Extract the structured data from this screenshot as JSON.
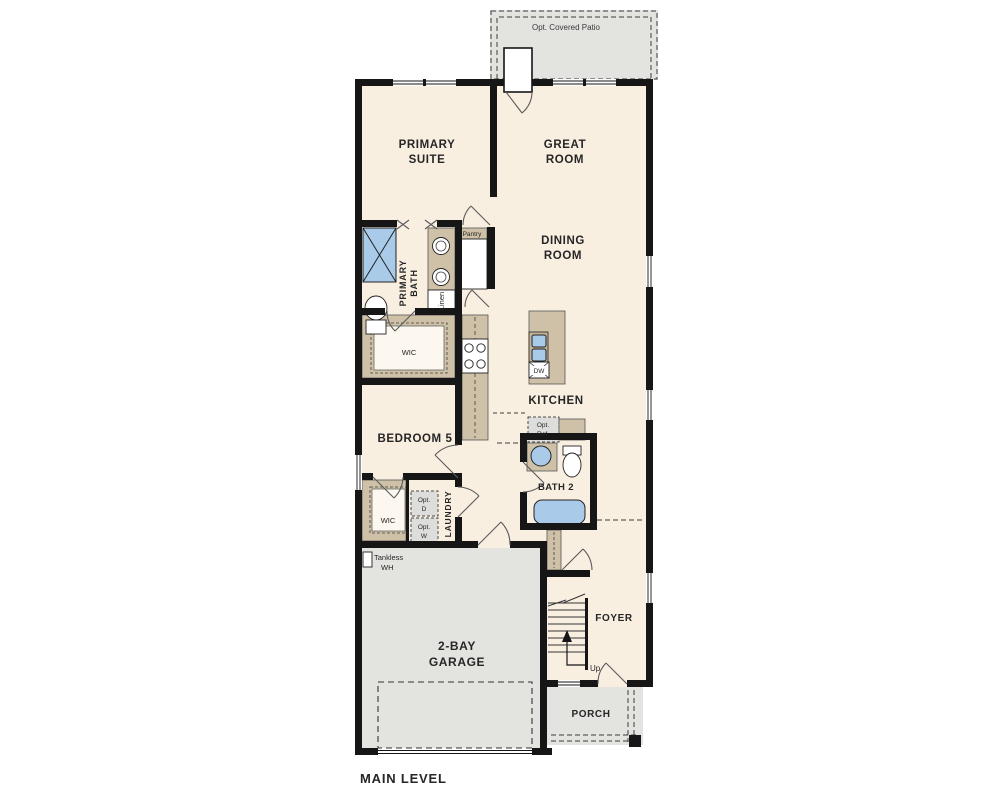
{
  "palette": {
    "floor": "#f8efe1",
    "outdoor": "#e3e3e0",
    "wall": "#161616",
    "cabinet_tan": "#cfc1a7",
    "fixture_blue": "#a9cbe9",
    "optional_gray": "#dddddb",
    "label_text": "#262626"
  },
  "title": "MAIN LEVEL",
  "outdoor_areas": {
    "covered_patio": "Opt. Covered Patio",
    "porch": "PORCH"
  },
  "rooms": {
    "primary_suite": {
      "line1": "PRIMARY",
      "line2": "SUITE"
    },
    "great_room": {
      "line1": "GREAT",
      "line2": "ROOM"
    },
    "dining_room": {
      "line1": "DINING",
      "line2": "ROOM"
    },
    "primary_bath": {
      "line1": "PRIMARY",
      "line2": "BATH"
    },
    "kitchen": "KITCHEN",
    "bedroom_5": "BEDROOM 5",
    "bath_2": "BATH 2",
    "laundry": "LAUNDRY",
    "foyer": "FOYER",
    "garage": {
      "line1": "2-BAY",
      "line2": "GARAGE"
    }
  },
  "closets": {
    "pantry": "Pantry",
    "linen": "Linen",
    "wic_primary": "WIC",
    "wic_bedroom5": "WIC"
  },
  "equipment": {
    "dishwasher": "DW",
    "opt_refrigerator": {
      "line1": "Opt.",
      "line2": "Ref."
    },
    "opt_dryer": {
      "line1": "Opt.",
      "line2": "D"
    },
    "opt_washer": {
      "line1": "Opt.",
      "line2": "W"
    },
    "tankless_wh": {
      "line1": "Tankless",
      "line2": "WH"
    }
  },
  "stairs": {
    "up": "Up"
  }
}
